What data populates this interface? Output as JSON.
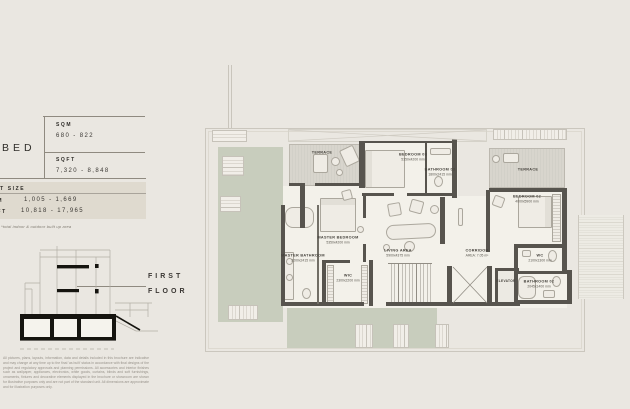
{
  "info_panel": {
    "bed_label": "BED",
    "area_table": {
      "sqm_label": "SQM",
      "sqm_value": "680 - 822",
      "sqft_label": "SQFT",
      "sqft_value": "7,320 - 8,848"
    },
    "plot_size": {
      "title": "PLOT SIZE",
      "sqm_label": "SQM",
      "sqm_value": "1,005 - 1,669",
      "sqft_label": "SQFT",
      "sqft_value": "10,818 - 17,965"
    },
    "note": "*total indoor & outdoor built up area"
  },
  "section_figure": {
    "label_line1": "FIRST",
    "label_line2": "FLOOR"
  },
  "floor_plan": {
    "rooms": [
      {
        "name": "TERRACE",
        "dim": ""
      },
      {
        "name": "BEDROOM 03",
        "dim": "5350x4200 mm"
      },
      {
        "name": "BATHROOM 03",
        "dim": "1800x2415 mm"
      },
      {
        "name": "TERRACE",
        "dim": ""
      },
      {
        "name": "BEDROOM 02",
        "dim": "4000x5900 mm"
      },
      {
        "name": "CORRIDOR",
        "dim": "AREA: 7.05 m²"
      },
      {
        "name": "ELEVATOR",
        "dim": ""
      },
      {
        "name": "WC",
        "dim": "2100x1300 mm"
      },
      {
        "name": "BATHROOM 02",
        "dim": "2045x1400 mm"
      },
      {
        "name": "MASTER BEDROOM",
        "dim": "5350x4200 mm"
      },
      {
        "name": "MASTER BATHROOM",
        "dim": "3200x2415 mm"
      },
      {
        "name": "WIC",
        "dim": "2300x2200 mm"
      },
      {
        "name": "LIVING AREA",
        "dim": "5900x4375 mm"
      }
    ]
  },
  "disclaimer": {
    "text": "All pictures, plans, layouts, information, data and details included in this brochure are indicative and may change at any time up to the final 'as built' status in accordance with final designs of the project and regulatory approvals and planning permissions. All accessories and interior finishes such as wallpaper, appliances, electronics, white goods, curtains, blinds and soft furnishings, ornaments, fixtures and decorative elements displayed in the brochure or showroom are shown for illustrative purposes only and are not part of the standard unit. All dimensions are approximate and for illustration purposes only."
  },
  "colors": {
    "background": "#EAE7E1",
    "landscape_green": "#C8CDBD",
    "wall_dark": "#57544E",
    "plot_box": "#DFDACF",
    "text_dark": "#3A3733"
  }
}
